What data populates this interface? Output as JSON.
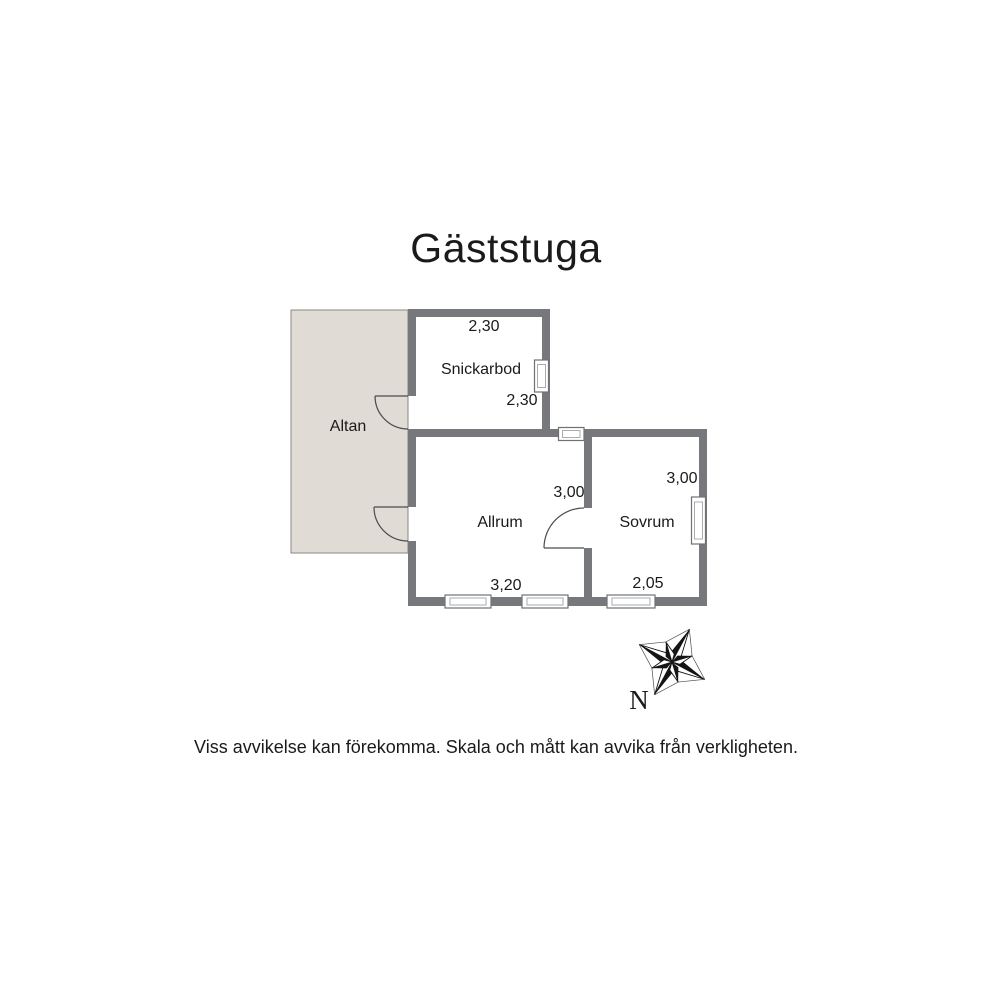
{
  "title": "Gäststuga",
  "plan": {
    "rooms": [
      {
        "name": "Altan"
      },
      {
        "name": "Snickarbod",
        "width_m": "2,30",
        "depth_m": "2,30"
      },
      {
        "name": "Allrum",
        "width_m": "3,20",
        "depth_m": "3,00"
      },
      {
        "name": "Sovrum",
        "width_m": "2,05",
        "depth_m": "3,00"
      }
    ]
  },
  "compass": {
    "north_label": "N"
  },
  "footer": {
    "disclaimer": "Viss avvikelse kan förekomma. Skala och mått kan avvika från verkligheten."
  },
  "colors": {
    "wall": "#76787B",
    "altan_fill": "#E0DCD5",
    "altan_border": "#8A8781",
    "text": "#1A1A1A"
  }
}
